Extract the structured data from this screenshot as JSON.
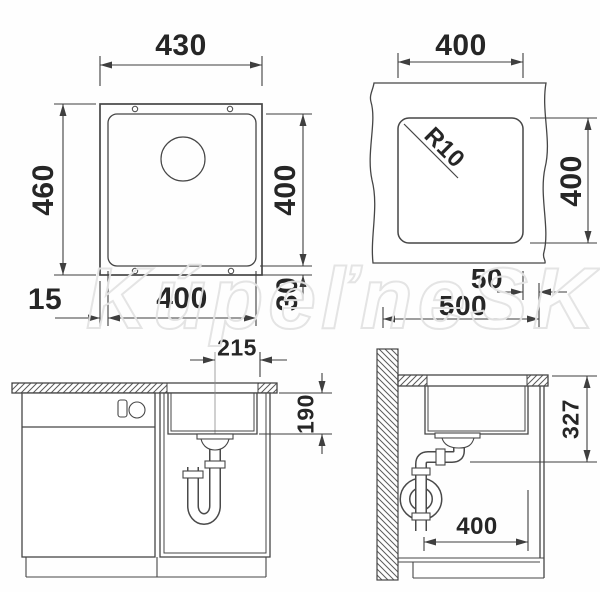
{
  "watermark": "KúpeľneSK",
  "plan_view": {
    "overall_width": "430",
    "overall_depth": "460",
    "bowl_depth": "400",
    "bowl_width": "400",
    "rim_side": "15",
    "rim_bottom": "30"
  },
  "cutout_view": {
    "cutout_width": "400",
    "cutout_depth": "400",
    "corner_radius": "R10",
    "edge_distance": "50",
    "cabinet_width": "500"
  },
  "front_view": {
    "drain_center_offset": "215",
    "bowl_inner_depth": "190"
  },
  "side_view": {
    "install_height": "327",
    "cabinet_clear_depth": "400"
  }
}
